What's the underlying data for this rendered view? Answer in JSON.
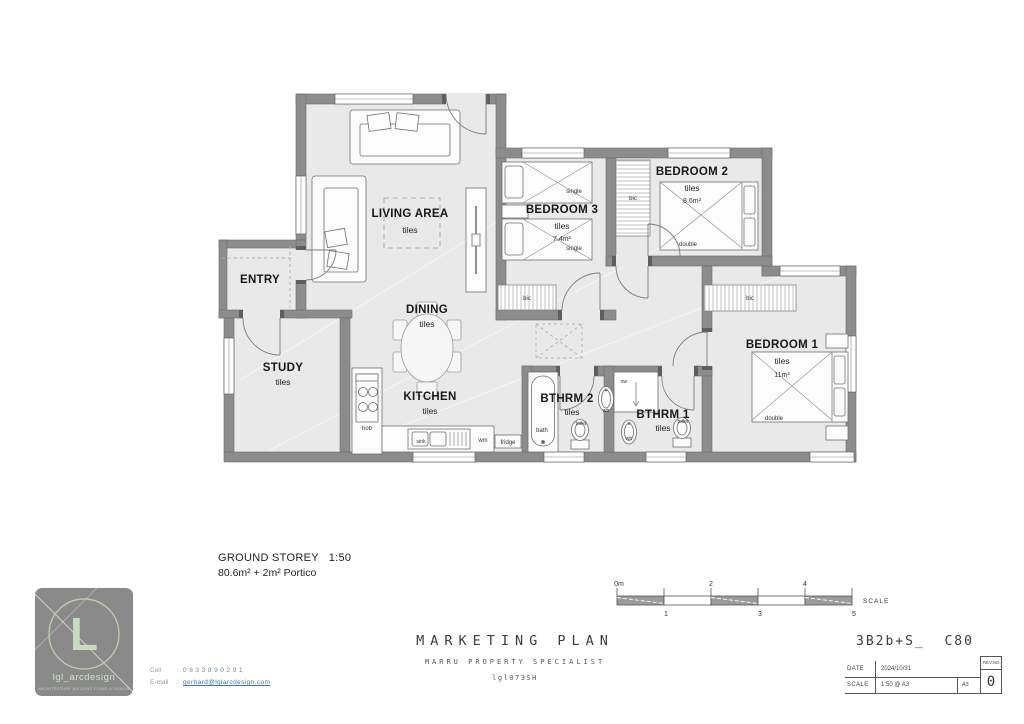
{
  "plan": {
    "rooms": {
      "living": {
        "name": "LIVING AREA",
        "finish": "tiles"
      },
      "entry": {
        "name": "ENTRY"
      },
      "study": {
        "name": "STUDY",
        "finish": "tiles"
      },
      "dining": {
        "name": "DINING",
        "finish": "tiles"
      },
      "kitchen": {
        "name": "KITCHEN",
        "finish": "tiles"
      },
      "bedroom3": {
        "name": "BEDROOM 3",
        "finish": "tiles",
        "area": "7.4m²"
      },
      "bedroom2": {
        "name": "BEDROOM 2",
        "finish": "tiles",
        "area": "8.6m²"
      },
      "bedroom1": {
        "name": "BEDROOM 1",
        "finish": "tiles",
        "area": "11m²"
      },
      "bthrm2": {
        "name": "BTHRM 2",
        "finish": "tiles"
      },
      "bthrm1": {
        "name": "BTHRM 1",
        "finish": "tiles"
      }
    },
    "fixtures": {
      "hob": "hob",
      "sink": "sink",
      "wm": "wm",
      "fridge": "fridge",
      "bath": "bath",
      "toilet": "toilet",
      "wb": "wb",
      "sw": "sw",
      "bic": "bic",
      "single": "single",
      "double": "double"
    }
  },
  "caption": {
    "line1": "GROUND STOREY   1:50",
    "line2": "80.6m² + 2m² Portico"
  },
  "scalebar": {
    "label": "SCALE",
    "ticks_top": [
      "0m",
      "2",
      "4"
    ],
    "ticks_bottom": [
      "1",
      "3",
      "5"
    ]
  },
  "titleblock": {
    "title": "MARKETING PLAN",
    "subtitle": "MARRU PROPERTY SPECIALIST",
    "drawing_code": "lgl073SH",
    "model_code": "3B2b+S_  C80",
    "date_label": "DATE",
    "date_value": "2024/10/31",
    "scale_label": "SCALE",
    "scale_value": "1:50 @ A3",
    "paper_size": "A3",
    "rev_label": "REV.NO.",
    "rev_value": "0"
  },
  "logo": {
    "monogram": "L",
    "brand": "lgl_arcdesign",
    "tagline": "ARCHITECTURE BUILDING PLANS & DESIGN"
  },
  "contact": {
    "cell_label": "Cell",
    "sep": ":",
    "cell_value": "0833890291",
    "email_label": "E-mail",
    "email_value": "gerhard@lglarcdesign.com"
  },
  "colors": {
    "wall": "#8c8c8c",
    "floor": "#e9e9e9",
    "logo_green": "#c8dbbd",
    "link_blue": "#3f74b5"
  }
}
